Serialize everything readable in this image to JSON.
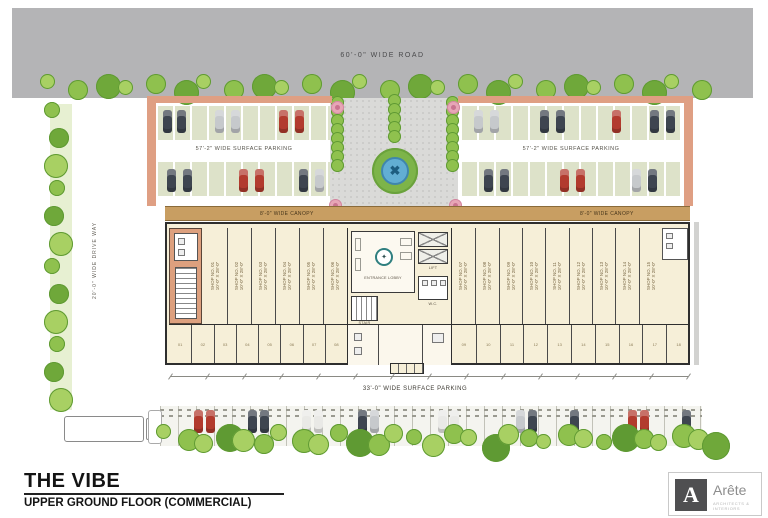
{
  "drawing": {
    "top_road_label": "60'-0\" WIDE ROAD",
    "left_road_label": "20'-0\" WIDE DRIVE WAY",
    "parking_left_label": "57'-2\" WIDE SURFACE PARKING",
    "parking_right_label": "57'-2\" WIDE SURFACE PARKING",
    "bottom_parking_label": "33'-0\" WIDE SURFACE PARKING",
    "canopy_left_label": "8'-0\" WIDE CANOPY",
    "canopy_right_label": "8'-0\" WIDE CANOPY"
  },
  "core": {
    "lobby_label": "ENTRANCE LOBBY",
    "lift_label": "LIFT",
    "stair_label": "STAIR",
    "wc_label": "W.C."
  },
  "shops_left": [
    {
      "no": "SHOP NO. 01",
      "size": "10'-0\" X 28'-0\""
    },
    {
      "no": "SHOP NO. 02",
      "size": "10'-0\" X 28'-0\""
    },
    {
      "no": "SHOP NO. 03",
      "size": "10'-0\" X 28'-0\""
    },
    {
      "no": "SHOP NO. 04",
      "size": "10'-0\" X 28'-0\""
    },
    {
      "no": "SHOP NO. 05",
      "size": "10'-0\" X 28'-0\""
    },
    {
      "no": "SHOP NO. 06",
      "size": "10'-0\" X 28'-0\""
    }
  ],
  "shops_right": [
    {
      "no": "SHOP NO. 07",
      "size": "10'-0\" X 28'-0\""
    },
    {
      "no": "SHOP NO. 08",
      "size": "10'-0\" X 28'-0\""
    },
    {
      "no": "SHOP NO. 09",
      "size": "10'-0\" X 28'-0\""
    },
    {
      "no": "SHOP NO. 10",
      "size": "10'-0\" X 28'-0\""
    },
    {
      "no": "SHOP NO. 11",
      "size": "10'-0\" X 28'-0\""
    },
    {
      "no": "SHOP NO. 12",
      "size": "10'-0\" X 28'-0\""
    },
    {
      "no": "SHOP NO. 13",
      "size": "10'-0\" X 28'-0\""
    },
    {
      "no": "SHOP NO. 14",
      "size": "10'-0\" X 28'-0\""
    },
    {
      "no": "SHOP NO. 15",
      "size": "10'-0\" X 28'-0\""
    }
  ],
  "stalls_left": [
    "01",
    "02",
    "03",
    "04",
    "05",
    "06",
    "07",
    "08"
  ],
  "stalls_right": [
    "09",
    "10",
    "11",
    "12",
    "13",
    "14",
    "15",
    "16",
    "17",
    "18"
  ],
  "title_block": {
    "project": "THE VIBE",
    "floor": "UPPER GROUND FLOOR (COMMERCIAL)"
  },
  "logo": {
    "mark": "A",
    "brand": "Arête",
    "tagline": "ARCHITECTS & INTERIORS"
  },
  "palette": {
    "road": "#b4b4b6",
    "building_fill": "#f6efd8",
    "salmon": "#df9f83",
    "canopy": "#c89e62",
    "tree_greens": [
      "#a8d063",
      "#8fc14e",
      "#6fa83a",
      "#5f9a33"
    ],
    "car_red": "#b23b2e",
    "car_navy": "#3e4550",
    "car_gray": "#c6c9cc",
    "car_white": "#e9e9e6",
    "fountain_blue": "#62aed3",
    "flower_pink": "#e7a6b6"
  }
}
